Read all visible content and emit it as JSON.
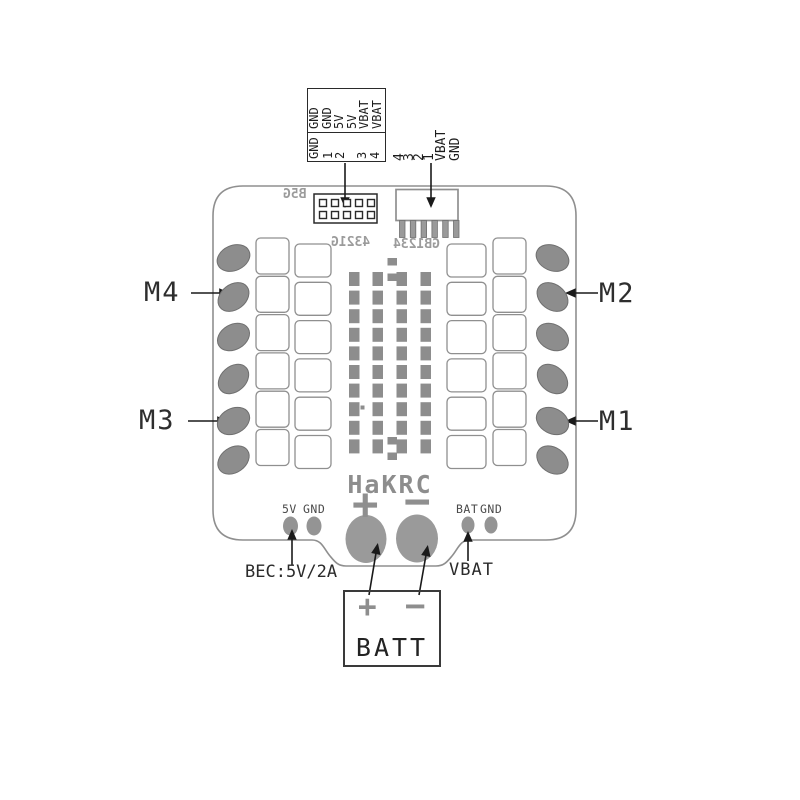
{
  "diagram": {
    "fc_header": {
      "signal_row": [
        "GND",
        "GND",
        "5V",
        "5V",
        "VBAT",
        "VBAT"
      ],
      "pin_row": [
        "GND",
        "1",
        "2",
        "3",
        "4"
      ]
    },
    "esc_connector_labels": [
      "4",
      "3",
      "2",
      "1",
      "VBAT",
      "GND"
    ],
    "silkscreen": {
      "left": "B5G",
      "center": "4321G",
      "right": "GB1234"
    },
    "logo": "HaKRC",
    "motor_labels": {
      "m1": "M1",
      "m2": "M2",
      "m3": "M3",
      "m4": "M4"
    },
    "bec_pad_labels": {
      "v5": "5V",
      "gnd": "GND"
    },
    "bat_pad_labels": {
      "bat": "BAT",
      "gnd": "GND"
    },
    "battery_pads": {
      "plus": "+",
      "minus": "−"
    },
    "annotations": {
      "bec": "BEC:5V/2A",
      "vbat": "VBAT"
    },
    "battery_box": {
      "plus": "+",
      "minus": "−",
      "label": "BATT"
    },
    "colors": {
      "pad_gray": "#8d8d8d",
      "big_pad_gray": "#9a9a9a",
      "outline_gray": "#8f8f8f",
      "silk_gray": "#9b9b9b",
      "ink": "#1a1a1a"
    }
  }
}
